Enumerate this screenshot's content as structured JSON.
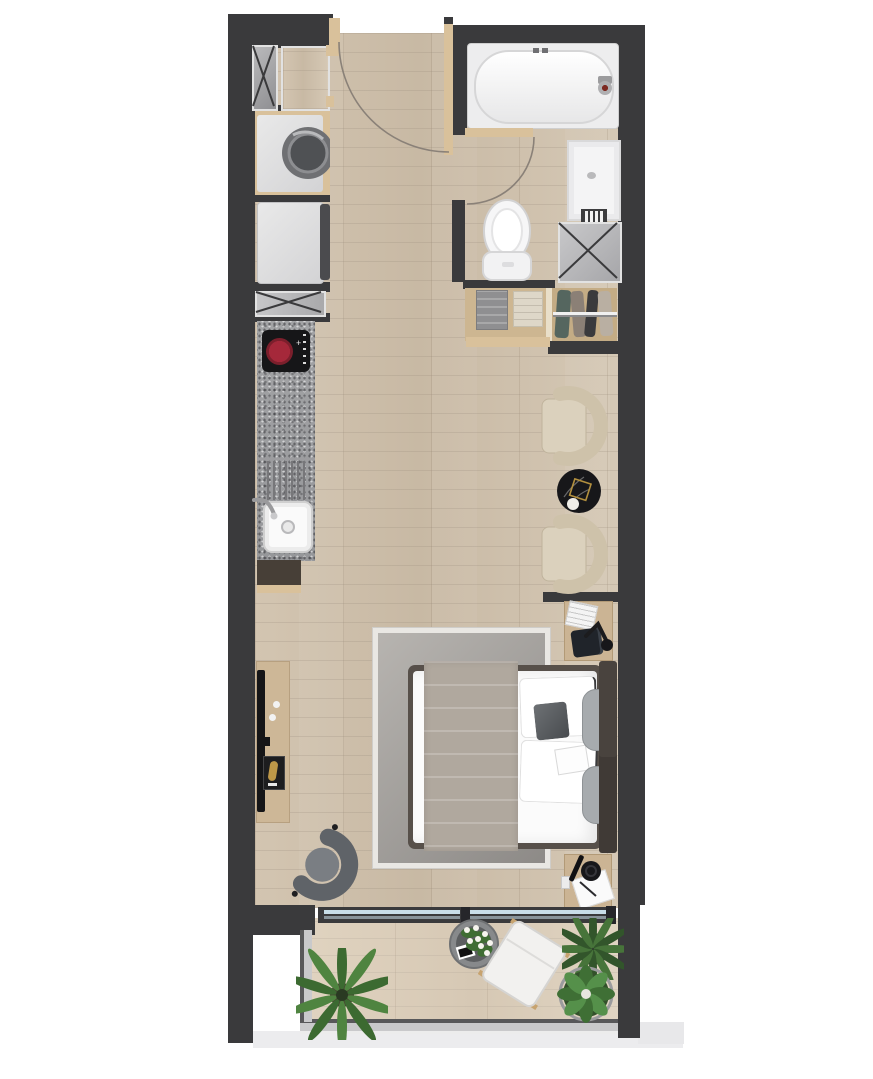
{
  "document": {
    "kind": "architectural floor plan, top-down 3D render, studio apartment with balcony",
    "visible_text": "none"
  },
  "palette": {
    "wall": "#3a3a3c",
    "floor_wood": "#cfc1ad",
    "balcony_wood": "#dbcebb",
    "counter_granite": "#9d9ea0",
    "fixture_white": "#f4f4f4",
    "accent_tan_door": "#d9c19b",
    "bed_throw": "#b0a89e",
    "armchair_cream": "#d0c4ad",
    "coffee_table_black": "#17171a",
    "gold_decor": "#b28f3e",
    "plant_green": "#3f6d33",
    "glass_blue": "#c8dde8",
    "swivel_chair_gray": "#5f6368"
  },
  "rooms": {
    "entry": {
      "features": [
        "entry-door",
        "door-swing-arc",
        "alcove-niche",
        "vent-shaft"
      ]
    },
    "bathroom": {
      "features": [
        "bathtub",
        "bathtub-faucet",
        "shower-tray",
        "towel-radiator",
        "toilet",
        "vent-shaft",
        "bathroom-door",
        "door-swing-arc",
        "towel-shelf",
        "clothes-rack"
      ]
    },
    "kitchen": {
      "features": [
        "washing-machine",
        "refrigerator",
        "vent-box",
        "counter",
        "induction-hob",
        "drainboard",
        "sink",
        "faucet",
        "base-cabinet"
      ]
    },
    "living_sleeping": {
      "features": [
        "armchair",
        "armchair",
        "round-coffee-table",
        "decor-gold-square",
        "partition-stub",
        "nightstand-with-lamp-and-phone",
        "double-bed",
        "headboard",
        "pillows",
        "accent-pillow",
        "bolster-cushions",
        "throw-blanket",
        "area-rug",
        "tv-console",
        "wall-tv",
        "framed-art",
        "swivel-armchair",
        "desk-nightstand"
      ]
    },
    "balcony": {
      "features": [
        "sliding-glass-door",
        "railing",
        "flower-planter",
        "lounge-chair",
        "potted-plant",
        "potted-plant",
        "potted-plant"
      ]
    }
  }
}
